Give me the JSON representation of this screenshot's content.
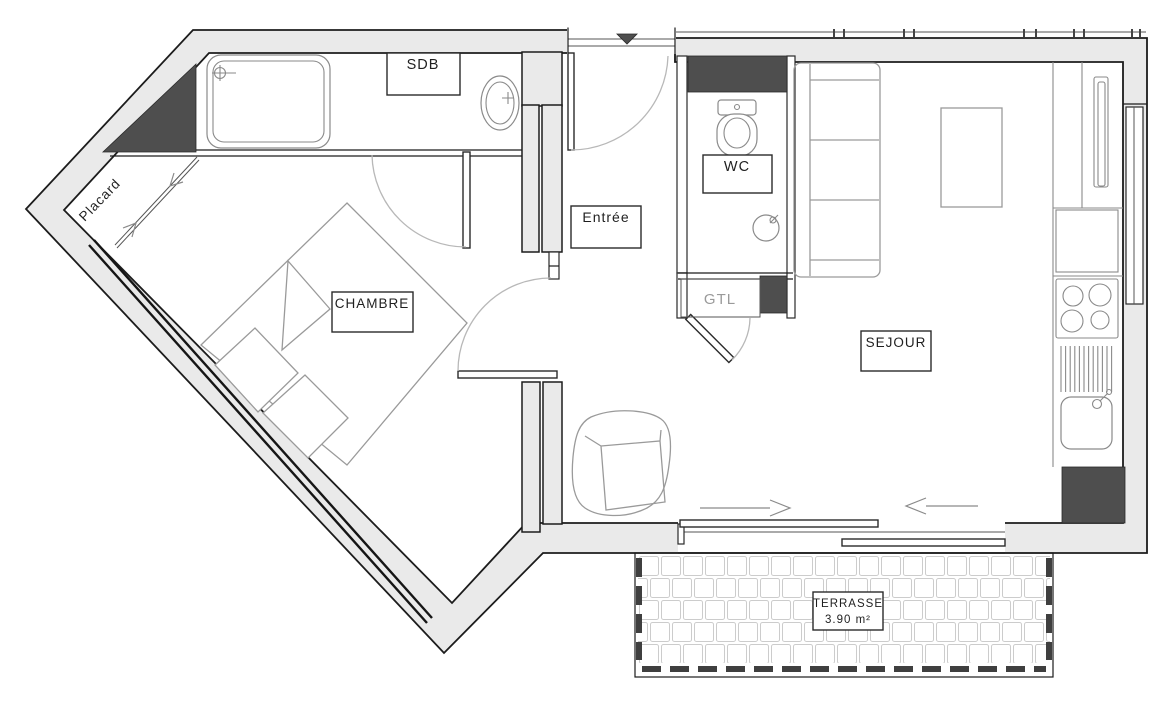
{
  "rooms": {
    "placard": {
      "label": "Placard"
    },
    "sdb": {
      "label": "SDB"
    },
    "chambre": {
      "label": "CHAMBRE"
    },
    "entree": {
      "label": "Entrée"
    },
    "wc": {
      "label": "WC"
    },
    "gtl": {
      "label": "GTL"
    },
    "sejour": {
      "label": "SEJOUR"
    },
    "terrasse": {
      "label": "TERRASSE",
      "area": "3.90 m²"
    }
  },
  "colors": {
    "wall_fill": "#eaeaea",
    "dark_fill": "#4e4e4e",
    "line": "#1c1c1c",
    "fixture": "#8a8a8a",
    "furniture": "#9a9a9a",
    "label_gray": "#9a9a9a",
    "tile": "#cccccc"
  }
}
